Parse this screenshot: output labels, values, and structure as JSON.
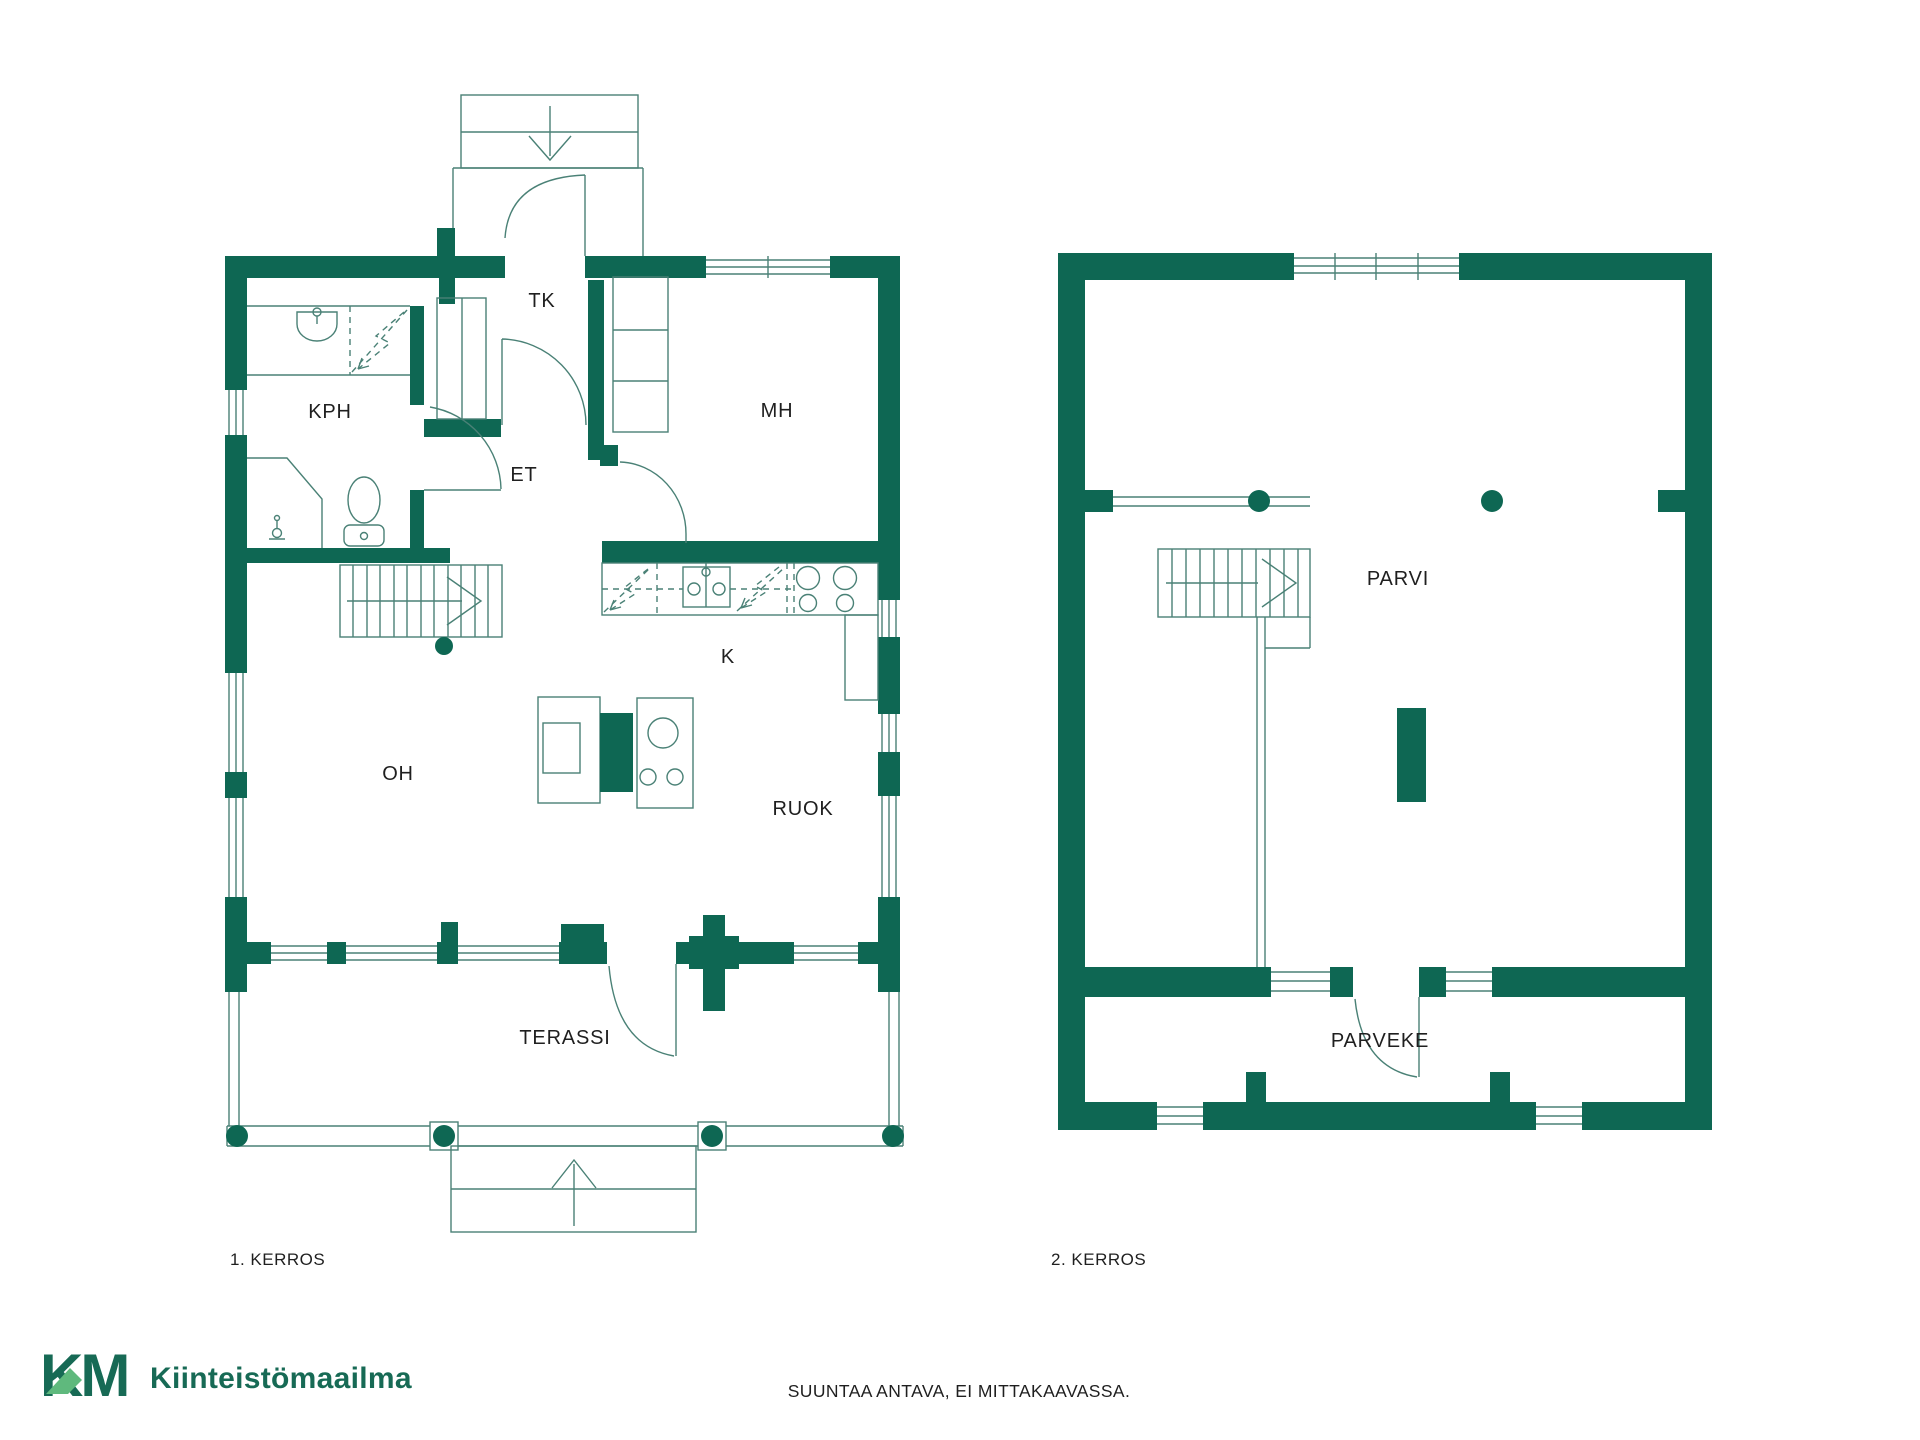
{
  "document": {
    "type": "floorplan",
    "disclaimer": "SUUNTAA ANTAVA, EI MITTAKAAVASSA."
  },
  "floor1": {
    "name": "1. KERROS",
    "rooms": {
      "kph": "KPH",
      "tk": "TK",
      "et": "ET",
      "mh": "MH",
      "k": "K",
      "oh": "OH",
      "ruok": "RUOK",
      "terassi": "TERASSI"
    }
  },
  "floor2": {
    "name": "2. KERROS",
    "rooms": {
      "parvi": "PARVI",
      "parveke": "PARVEKE"
    }
  },
  "footer": {
    "logo_mark": "KM",
    "brand": "Kiinteistömaailma",
    "disclaimer": "SUUNTAA ANTAVA, EI MITTAKAAVASSA."
  },
  "colors": {
    "wall_green": "#0e6753",
    "line_teal": "#4a8176",
    "logo_dark_green": "#176a55",
    "logo_light_green": "#5fb97d",
    "label_text": "#1f1f1f",
    "background": "#ffffff"
  },
  "icons": {
    "stairs_direction_arrow": "→",
    "entry_arrow": "↓",
    "terrace_steps_arrow": "↑"
  }
}
